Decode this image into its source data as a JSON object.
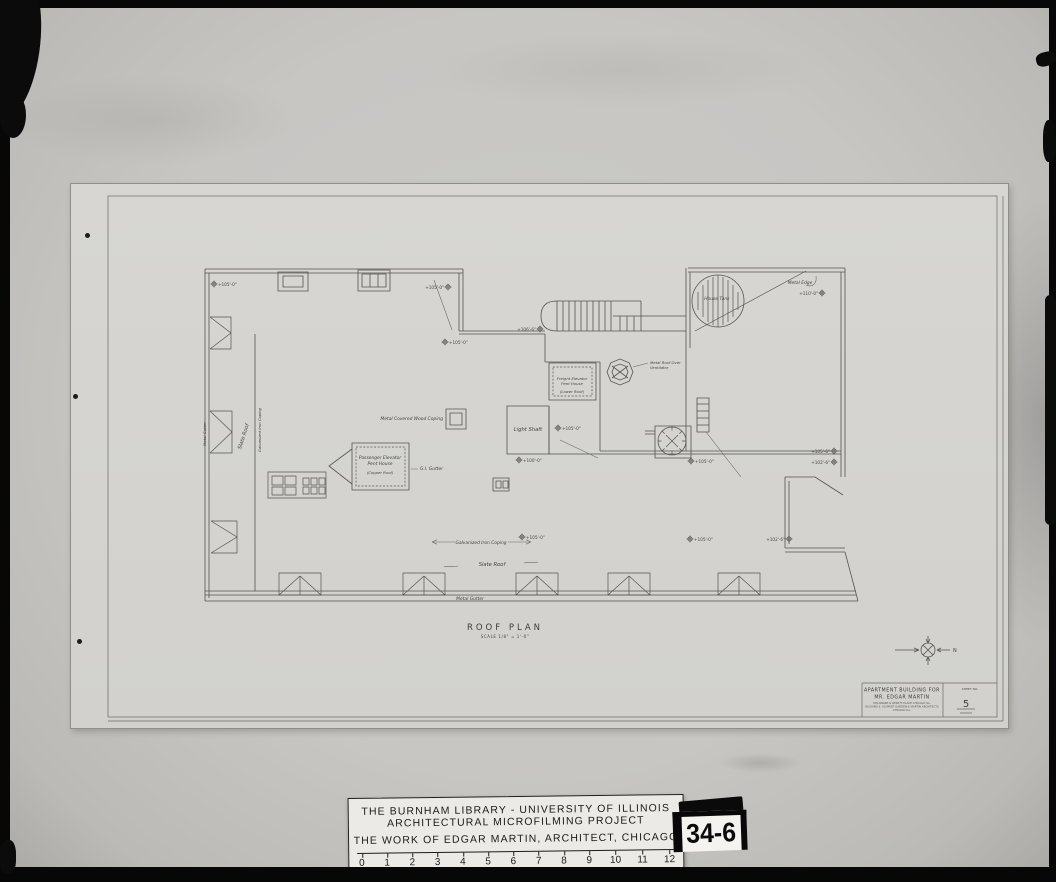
{
  "sheet": {
    "title_block": {
      "line1": "APARTMENT BUILDING FOR",
      "line2": "MR. EDGAR MARTIN",
      "address": "DELAWARE & DEWITT PLACE CHICAGO ILL.",
      "firm": "RICHARD E. SCHMIDT GARDEN & MARTIN ARCHITECTS",
      "firm2": "CHICAGO ILL.",
      "sheet_no_label": "SHEET NO.",
      "sheet_no": "5"
    },
    "plan": {
      "title": "ROOF PLAN",
      "scale_note": "SCALE 1/8\" = 1'-0\"",
      "labels": {
        "house_tank": "House Tank",
        "metal_edge": "Metal Edge",
        "freight_penthouse_1": "Freight Elevator",
        "freight_penthouse_2": "Pent House",
        "freight_penthouse_3": "(Lower Roof)",
        "vent_1": "Metal Roof Over",
        "vent_2": "Ventilator",
        "light_shaft": "Light Shaft",
        "passenger_penthouse_1": "Passenger Elevator",
        "passenger_penthouse_2": "Pent House",
        "passenger_penthouse_3": "(Copper Roof)",
        "gi_gutter": "G.I. Gutter",
        "coping_note": "Metal Covered Wood Coping",
        "galv_coping_bottom": "Galvanized Iron Coping",
        "slate_roof_bottom": "Slate Roof",
        "metal_gutter_bottom": "Metal Gutter",
        "slate_roof_left": "Slate Roof",
        "galv_coping_left": "Galvanized Iron Coping",
        "metal_gutter_left": "Metal Gutter",
        "north": "N"
      },
      "elevation_markers": [
        {
          "cx": 214,
          "cy": 284,
          "tx": 218,
          "ty": 286,
          "anchor": "start",
          "label": "+105'-0\""
        },
        {
          "cx": 448,
          "cy": 287,
          "tx": 444,
          "ty": 289,
          "anchor": "end",
          "label": "+105'-0\""
        },
        {
          "cx": 445,
          "cy": 342,
          "tx": 449,
          "ty": 344,
          "anchor": "start",
          "label": "+105'-0\""
        },
        {
          "cx": 540,
          "cy": 329,
          "tx": 536,
          "ty": 331,
          "anchor": "end",
          "label": "+106'-6\""
        },
        {
          "cx": 822,
          "cy": 293,
          "tx": 818,
          "ty": 295,
          "anchor": "end",
          "label": "+110'-0\""
        },
        {
          "cx": 558,
          "cy": 428,
          "tx": 562,
          "ty": 430,
          "anchor": "start",
          "label": "+105'-0\""
        },
        {
          "cx": 519,
          "cy": 460,
          "tx": 523,
          "ty": 462,
          "anchor": "start",
          "label": "+100'-0\""
        },
        {
          "cx": 691,
          "cy": 461,
          "tx": 695,
          "ty": 463,
          "anchor": "start",
          "label": "+105'-0\""
        },
        {
          "cx": 834,
          "cy": 451,
          "tx": 830,
          "ty": 453,
          "anchor": "end",
          "label": "+105'-6\""
        },
        {
          "cx": 834,
          "cy": 462,
          "tx": 830,
          "ty": 464,
          "anchor": "end",
          "label": "+102'-6\""
        },
        {
          "cx": 690,
          "cy": 539,
          "tx": 694,
          "ty": 541,
          "anchor": "start",
          "label": "+105'-0\""
        },
        {
          "cx": 789,
          "cy": 539,
          "tx": 785,
          "ty": 541,
          "anchor": "end",
          "label": "+102'-6\""
        },
        {
          "cx": 522,
          "cy": 537,
          "tx": 526,
          "ty": 539,
          "anchor": "start",
          "label": "+105'-0\""
        }
      ]
    }
  },
  "caption_card": {
    "line1": "THE BURNHAM LIBRARY - UNIVERSITY OF ILLINOIS",
    "line2": "ARCHITECTURAL MICROFILMING PROJECT",
    "line3": "THE WORK OF EDGAR MARTIN, ARCHITECT, CHICAGO",
    "ruler_ticks": [
      "0",
      "1",
      "2",
      "3",
      "4",
      "5",
      "6",
      "7",
      "8",
      "9",
      "10",
      "11",
      "12"
    ],
    "ruler_caption": "scale in inches"
  },
  "frame_tag": {
    "text": "34-6"
  }
}
